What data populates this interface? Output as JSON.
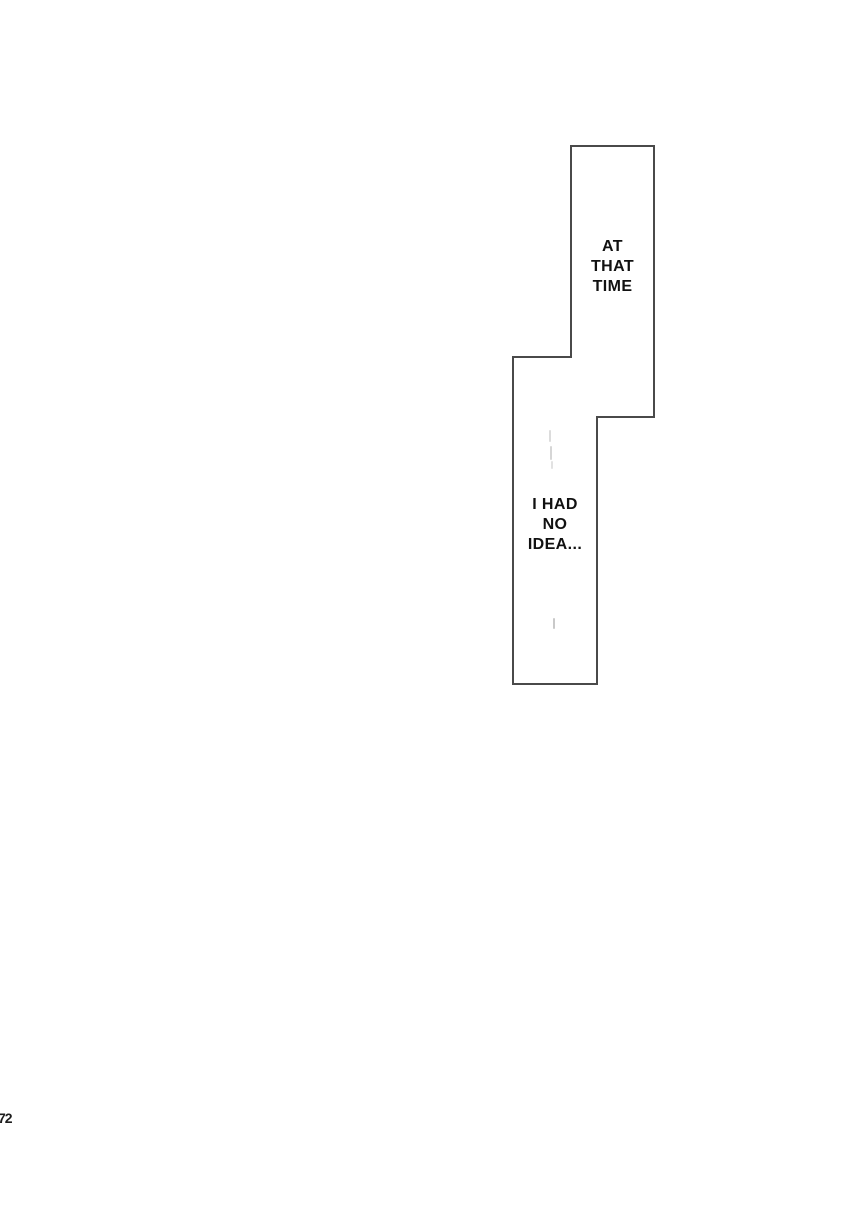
{
  "page": {
    "background_color": "#ffffff",
    "page_number": "72"
  },
  "panel": {
    "type": "stepped-speech-panel",
    "border_color": "#4a4a4a",
    "fill_color": "#ffffff",
    "text_color": "#111111",
    "captions": [
      {
        "text": "AT THAT TIME",
        "lines": [
          "AT",
          "THAT",
          "TIME"
        ]
      },
      {
        "text": "I HAD NO IDEA...",
        "lines": [
          "I HAD",
          "NO",
          "IDEA..."
        ]
      }
    ],
    "artifacts": [
      {
        "name": "faint-eraser-mark",
        "color": "#dcdcdc"
      },
      {
        "name": "faint-eraser-mark",
        "color": "#d6d6d6"
      },
      {
        "name": "faint-eraser-mark",
        "color": "#e2e2e2"
      },
      {
        "name": "faint-eraser-mark",
        "color": "#c9c9c9"
      }
    ]
  }
}
